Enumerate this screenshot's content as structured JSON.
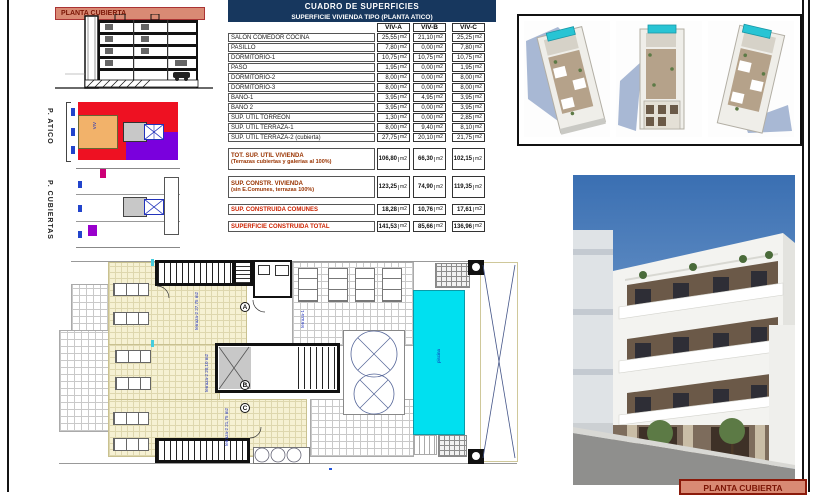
{
  "sheet": {
    "section_band_label": "PLANTA CUBIERTA",
    "footer_label": "PLANTA CUBIERTA"
  },
  "side_plans": {
    "atico_label": "P. ATICO",
    "cubiertas_label": "P. CUBIERTAS",
    "atico_unit_label": "VIV"
  },
  "table": {
    "title": "CUADRO DE SUPERFICIES",
    "subtitle": "SUPERFICIE VIVIENDA TIPO  (PLANTA ATICO)",
    "columns": [
      "VIV-A",
      "VIV-B",
      "VIV-C"
    ],
    "unit": "m2",
    "rows": [
      {
        "label": "SALON COMEDOR COCINA",
        "values": [
          "25,55",
          "21,10",
          "25,25"
        ]
      },
      {
        "label": "PASILLO",
        "values": [
          "7,80",
          "0,00",
          "7,80"
        ]
      },
      {
        "label": "DORMITORIO-1",
        "values": [
          "10,75",
          "10,75",
          "10,75"
        ]
      },
      {
        "label": "PASO",
        "values": [
          "1,95",
          "0,00",
          "1,95"
        ]
      },
      {
        "label": "DORMITORIO-2",
        "values": [
          "8,00",
          "0,00",
          "8,00"
        ]
      },
      {
        "label": "DORMITORIO-3",
        "values": [
          "8,00",
          "0,00",
          "8,00"
        ]
      },
      {
        "label": "BAÑO-1",
        "values": [
          "3,95",
          "4,95",
          "3,95"
        ]
      },
      {
        "label": "BAÑO 2",
        "values": [
          "3,95",
          "0,00",
          "3,95"
        ]
      },
      {
        "label": "SUP. UTIL TORREON",
        "values": [
          "1,30",
          "0,00",
          "2,85"
        ]
      },
      {
        "label": "SUP. UTIL TERRAZA-1",
        "values": [
          "8,00",
          "9,40",
          "8,10"
        ]
      },
      {
        "label": "SUP. UTIL TERRAZA-2 (cubierta)",
        "values": [
          "27,75",
          "20,10",
          "21,75"
        ]
      }
    ],
    "summary_rows": [
      {
        "label": "TOT. SUP. UTIL VIVIENDA",
        "sublabel": "(Terrazas cubiertas y galerias al 100%)",
        "values": [
          "106,80",
          "66,30",
          "102,15"
        ]
      },
      {
        "label": "SUP. CONSTR. VIVIENDA",
        "sublabel": "(sin E.Comunes, terrazas 100%)",
        "values": [
          "123,25",
          "74,90",
          "119,35"
        ]
      },
      {
        "label": "SUP. CONSTRUIDA COMUNES",
        "sublabel": "",
        "values": [
          "18,28",
          "10,76",
          "17,61"
        ]
      },
      {
        "label": "SUPERFICIE CONSTRUIDA TOTAL",
        "sublabel": "",
        "values": [
          "141,53",
          "85,66",
          "136,96"
        ]
      }
    ]
  },
  "floor_plan": {
    "unit_letters": [
      "A",
      "B",
      "C"
    ],
    "labels": {
      "terrace_a": "terraza-2  27,75 m2",
      "terrace_b": "terraza-2  20,10 m2",
      "terrace_c": "terraza-2  21,75 m2",
      "terrace_roof": "terraza-1",
      "pool": "piscina"
    }
  },
  "colors": {
    "header_navy": "#17375E",
    "salmon_band": "#D98A74",
    "band_text_red": "#7A1505",
    "summary_maroon": "#993300",
    "summary_red": "#CC2200",
    "pool_cyan": "#00E0F0",
    "atico_red": "#EE1122",
    "atico_purple": "#7A00DD",
    "atico_orange": "#F2B26A",
    "plan_cream": "#F6F1D3",
    "annotation_blue": "#2233BB"
  }
}
